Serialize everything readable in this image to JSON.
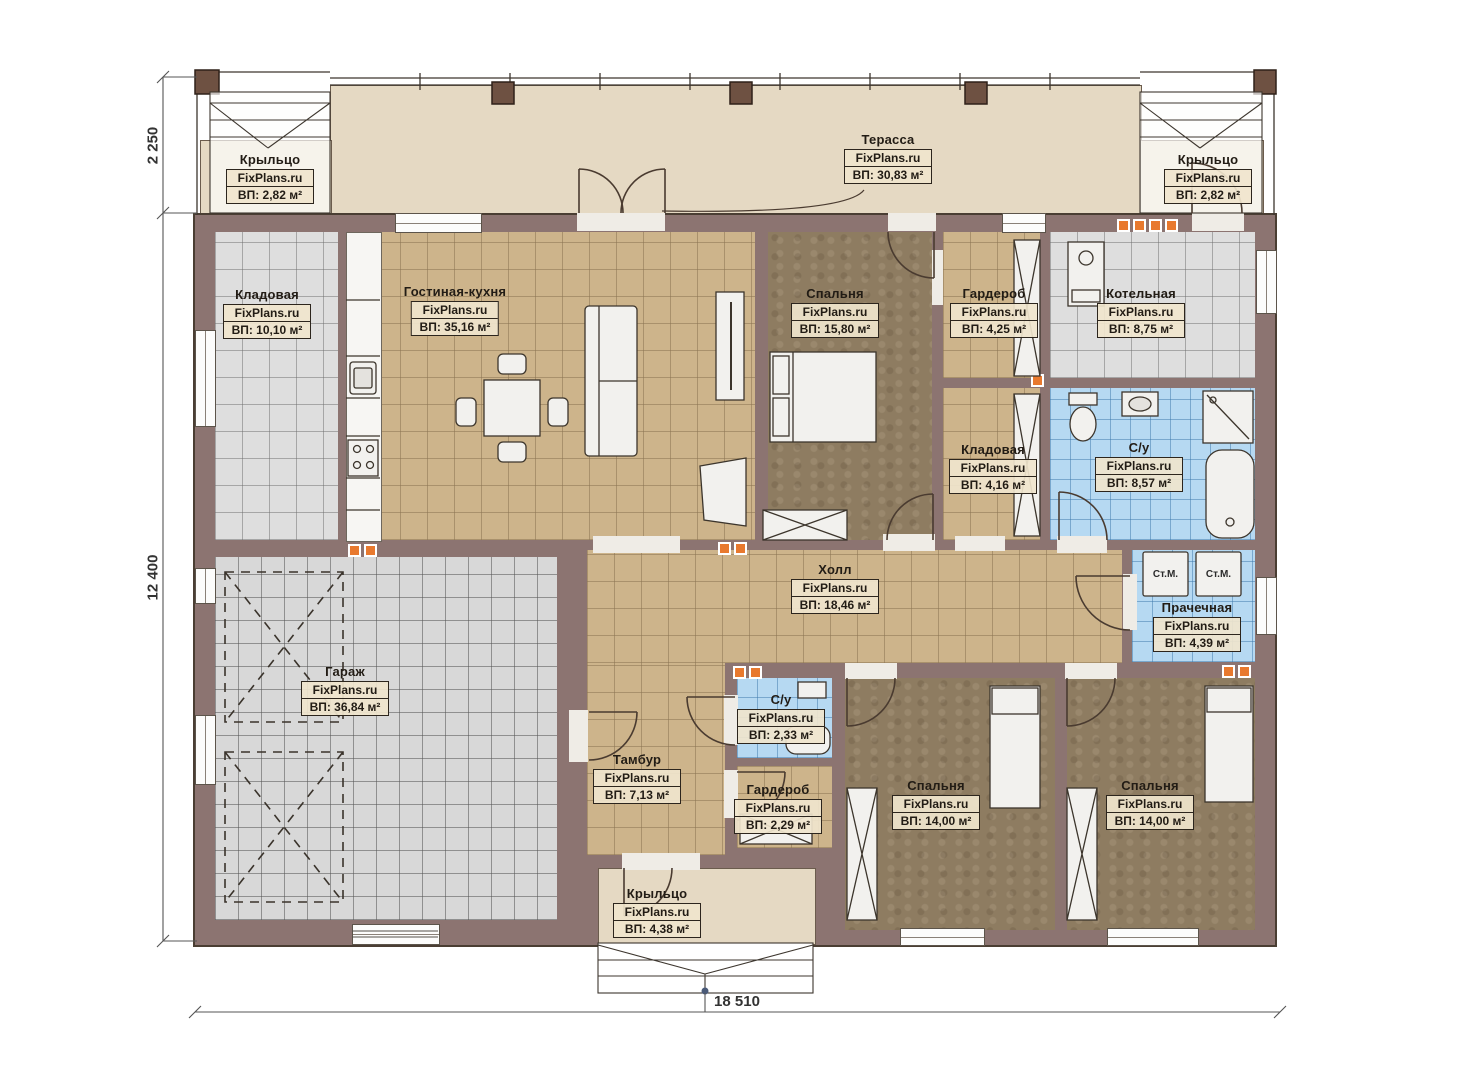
{
  "watermark": "FixPlans.ru",
  "dimensions": {
    "width_total": "18 510",
    "height_top": "2 250",
    "height_main": "12 400"
  },
  "appliances": {
    "washing_machine_1": "Ст.М.",
    "washing_machine_2": "Ст.М."
  },
  "rooms": [
    {
      "id": "porch-top-left",
      "name": "Крыльцо",
      "area": "ВП: 2,82 м²"
    },
    {
      "id": "terrace",
      "name": "Терасса",
      "area": "ВП: 30,83 м²"
    },
    {
      "id": "porch-top-right",
      "name": "Крыльцо",
      "area": "ВП: 2,82 м²"
    },
    {
      "id": "storage-top-left",
      "name": "Кладовая",
      "area": "ВП: 10,10 м²"
    },
    {
      "id": "living-kitchen",
      "name": "Гостиная-кухня",
      "area": "ВП: 35,16 м²"
    },
    {
      "id": "bedroom-top",
      "name": "Спальня",
      "area": "ВП: 15,80 м²"
    },
    {
      "id": "wardrobe-top",
      "name": "Гардероб",
      "area": "ВП: 4,25 м²"
    },
    {
      "id": "boiler-room",
      "name": "Котельная",
      "area": "ВП: 8,75 м²"
    },
    {
      "id": "storage-mid",
      "name": "Кладовая",
      "area": "ВП: 4,16 м²"
    },
    {
      "id": "bathroom-big",
      "name": "С/у",
      "area": "ВП: 8,57 м²"
    },
    {
      "id": "hall",
      "name": "Холл",
      "area": "ВП: 18,46 м²"
    },
    {
      "id": "laundry",
      "name": "Прачечная",
      "area": "ВП: 4,39 м²"
    },
    {
      "id": "garage",
      "name": "Гараж",
      "area": "ВП: 36,84 м²"
    },
    {
      "id": "vestibule",
      "name": "Тамбур",
      "area": "ВП: 7,13 м²"
    },
    {
      "id": "bathroom-small",
      "name": "С/у",
      "area": "ВП: 2,33 м²"
    },
    {
      "id": "wardrobe-small",
      "name": "Гардероб",
      "area": "ВП: 2,29 м²"
    },
    {
      "id": "bedroom-mid",
      "name": "Спальня",
      "area": "ВП: 14,00 м²"
    },
    {
      "id": "bedroom-right",
      "name": "Спальня",
      "area": "ВП: 14,00 м²"
    },
    {
      "id": "porch-bottom",
      "name": "Крыльцо",
      "area": "ВП: 4,38 м²"
    }
  ],
  "colors": {
    "wall": "#8c7471",
    "terrace_floor": "#e5d9c3",
    "tan_tile": "#cdb48b",
    "gray_tile": "#dedede",
    "blue_tile": "#b6d9f2",
    "bedroom_floor": "#8e7c61",
    "vent_orange": "#e8792e",
    "label_bg": "#f0e5cd"
  }
}
